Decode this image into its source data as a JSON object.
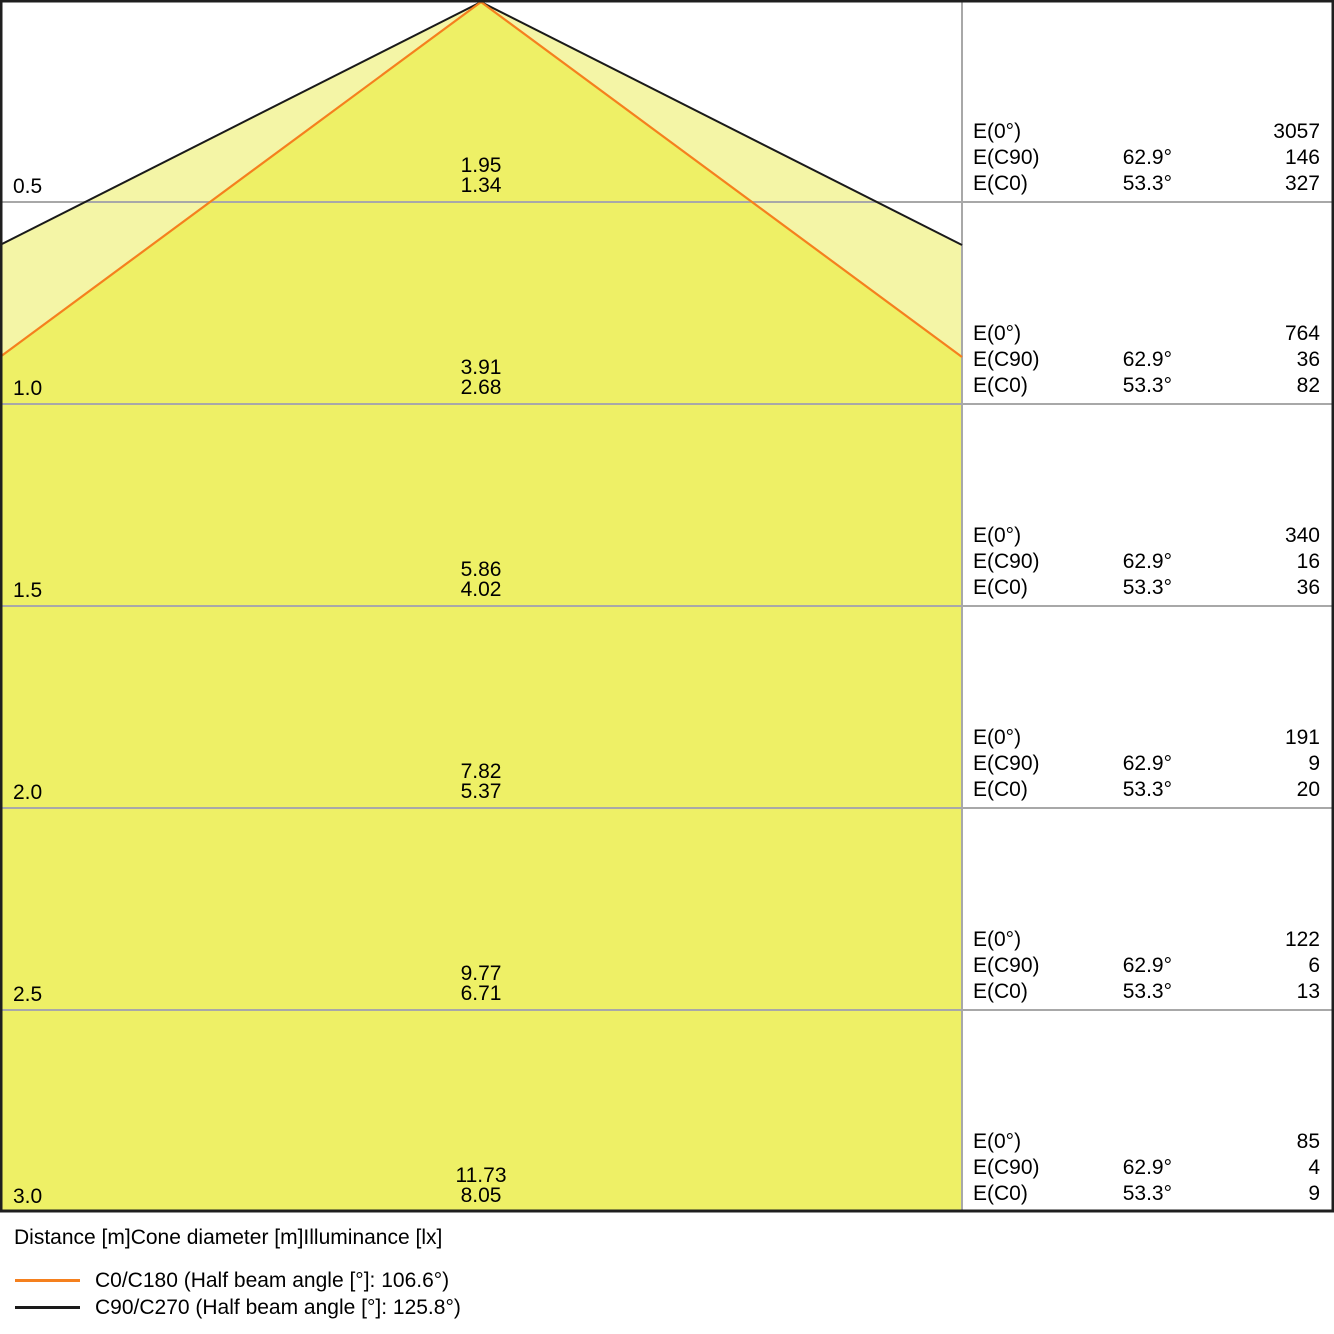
{
  "colors": {
    "inner-cone": "#eef066",
    "outer-cone": "#f4f5a6",
    "c0-line": "#f5801e",
    "beam-black": "#1a1a1a",
    "grid-gray": "#a8a8a8",
    "border-black": "#1f1f1f"
  },
  "rows": [
    {
      "distance": "0.5",
      "cone_c90": "1.95",
      "cone_c0": "1.34",
      "e": [
        {
          "label": "E(0°)",
          "angle": "",
          "value": "3057"
        },
        {
          "label": "E(C90)",
          "angle": "62.9°",
          "value": "146"
        },
        {
          "label": "E(C0)",
          "angle": "53.3°",
          "value": "327"
        }
      ]
    },
    {
      "distance": "1.0",
      "cone_c90": "3.91",
      "cone_c0": "2.68",
      "e": [
        {
          "label": "E(0°)",
          "angle": "",
          "value": "764"
        },
        {
          "label": "E(C90)",
          "angle": "62.9°",
          "value": "36"
        },
        {
          "label": "E(C0)",
          "angle": "53.3°",
          "value": "82"
        }
      ]
    },
    {
      "distance": "1.5",
      "cone_c90": "5.86",
      "cone_c0": "4.02",
      "e": [
        {
          "label": "E(0°)",
          "angle": "",
          "value": "340"
        },
        {
          "label": "E(C90)",
          "angle": "62.9°",
          "value": "16"
        },
        {
          "label": "E(C0)",
          "angle": "53.3°",
          "value": "36"
        }
      ]
    },
    {
      "distance": "2.0",
      "cone_c90": "7.82",
      "cone_c0": "5.37",
      "e": [
        {
          "label": "E(0°)",
          "angle": "",
          "value": "191"
        },
        {
          "label": "E(C90)",
          "angle": "62.9°",
          "value": "9"
        },
        {
          "label": "E(C0)",
          "angle": "53.3°",
          "value": "20"
        }
      ]
    },
    {
      "distance": "2.5",
      "cone_c90": "9.77",
      "cone_c0": "6.71",
      "e": [
        {
          "label": "E(0°)",
          "angle": "",
          "value": "122"
        },
        {
          "label": "E(C90)",
          "angle": "62.9°",
          "value": "6"
        },
        {
          "label": "E(C0)",
          "angle": "53.3°",
          "value": "13"
        }
      ]
    },
    {
      "distance": "3.0",
      "cone_c90": "11.73",
      "cone_c0": "8.05",
      "e": [
        {
          "label": "E(0°)",
          "angle": "",
          "value": "85"
        },
        {
          "label": "E(C90)",
          "angle": "62.9°",
          "value": "4"
        },
        {
          "label": "E(C0)",
          "angle": "53.3°",
          "value": "9"
        }
      ]
    }
  ],
  "footer": {
    "caption": "Distance [m]Cone diameter [m]Illuminance [lx]",
    "legend": [
      {
        "label": "C0/C180 (Half beam angle [°]: 106.6°)"
      },
      {
        "label": "C90/C270 (Half beam angle [°]: 125.8°)"
      }
    ]
  },
  "chart_data": {
    "type": "table",
    "title": "Luminous emittance / light cone diagram",
    "xlabel": "Distance [m]",
    "ylabel": "Illuminance [lx]",
    "distances_m": [
      0.5,
      1.0,
      1.5,
      2.0,
      2.5,
      3.0
    ],
    "cone_diameter_c90_c270_m": [
      1.95,
      3.91,
      5.86,
      7.82,
      9.77,
      11.73
    ],
    "cone_diameter_c0_c180_m": [
      1.34,
      2.68,
      4.02,
      5.37,
      6.71,
      8.05
    ],
    "series": [
      {
        "name": "E(0°) [lx]",
        "values": [
          3057,
          764,
          340,
          191,
          122,
          85
        ]
      },
      {
        "name": "E(C90) [lx]",
        "values": [
          146,
          36,
          16,
          9,
          6,
          4
        ]
      },
      {
        "name": "E(C0) [lx]",
        "values": [
          327,
          82,
          36,
          20,
          13,
          9
        ]
      }
    ],
    "EC90_angle_deg": 62.9,
    "EC0_angle_deg": 53.3,
    "half_beam_angle_C0_C180_deg": 106.6,
    "half_beam_angle_C90_C270_deg": 125.8,
    "legend_position": "bottom-left",
    "grid": true
  }
}
